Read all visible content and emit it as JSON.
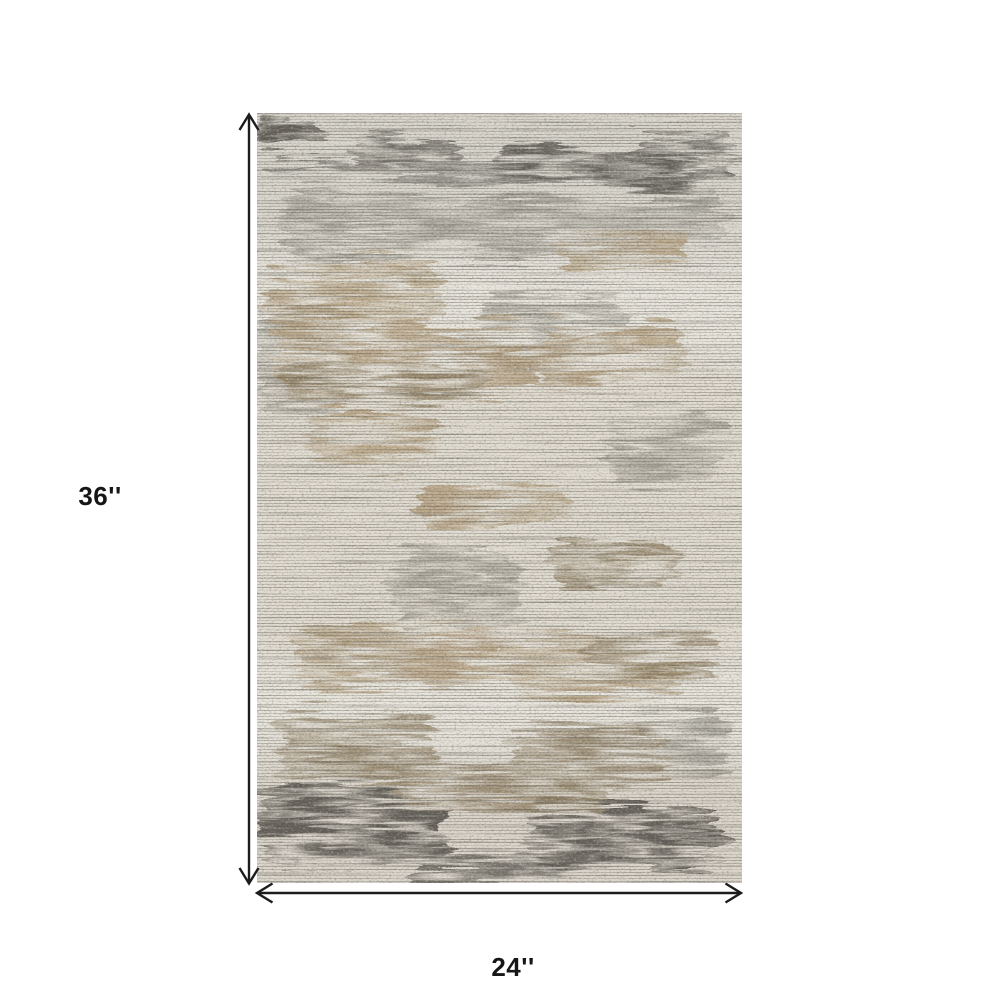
{
  "page": {
    "background": "#ffffff"
  },
  "diagram": {
    "kind": "rug-dimension-diagram",
    "product": "distressed abstract area rug",
    "height_label": "36''",
    "width_label": "24''",
    "line_color": "#1c1c1c",
    "label_color": "#161616",
    "rug_colors": {
      "base": "#e9e6de",
      "light": "#f1eee6",
      "gray": "#9b988e",
      "tan": "#b39c79",
      "brown": "#8c7a5c",
      "charcoal": "#3f3d37",
      "thread": "#6b675e",
      "thread_dark": "#514e46"
    }
  }
}
